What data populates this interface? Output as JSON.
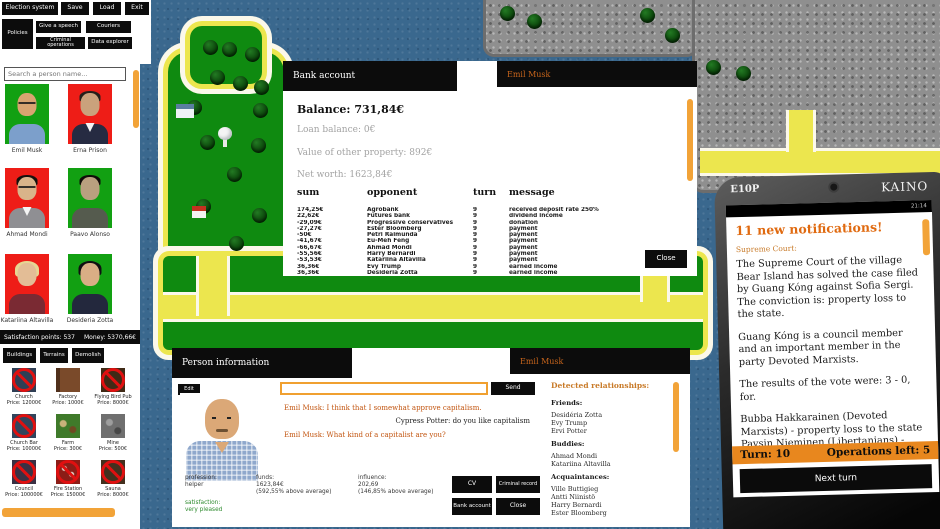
{
  "menu": {
    "items": [
      "Election system",
      "Save",
      "Load",
      "Exit",
      "Policies",
      "Give a speech",
      "Couriers",
      "Criminal operations",
      "Data explorer"
    ]
  },
  "sidebar": {
    "search_placeholder": "Search a person name...",
    "people": [
      "Emil Musk",
      "Erna Prison",
      "Ahmad Mondi",
      "Paavo Alonso",
      "Katariina Altavilla",
      "Desideria Zotta"
    ],
    "status": {
      "satisfaction": "Satisfaction points: 537",
      "money": "Money: 5370,66€"
    },
    "tabs": [
      "Buildings",
      "Terrains",
      "Demolish"
    ],
    "buildings": [
      {
        "name": "Church",
        "price": "Price: 12000€"
      },
      {
        "name": "Factory",
        "price": "Price: 1000€"
      },
      {
        "name": "Flying Bird Pub",
        "price": "Price: 8000€"
      },
      {
        "name": "Church Bar",
        "price": "Price: 10000€"
      },
      {
        "name": "Farm",
        "price": "Price: 300€"
      },
      {
        "name": "Mine",
        "price": "Price: 500€"
      },
      {
        "name": "Council",
        "price": "Price: 100000€"
      },
      {
        "name": "Fire Station",
        "price": "Price: 15000€"
      },
      {
        "name": "Sauna",
        "price": "Price: 8000€"
      }
    ]
  },
  "bank": {
    "title": "Bank account",
    "person_tab": "Emil Musk",
    "balance": "Balance: 731,84€",
    "loan": "Loan balance: 0€",
    "property": "Value of other property: 892€",
    "net_worth": "Net worth: 1623,84€",
    "columns": [
      "sum",
      "opponent",
      "turn",
      "message"
    ],
    "rows": [
      [
        "174,25€",
        "Agrobank",
        "9",
        "received deposit rate 250%"
      ],
      [
        "22,62€",
        "Futures bank",
        "9",
        "dividend income"
      ],
      [
        "-29,09€",
        "Progressive conservatives",
        "9",
        "donation"
      ],
      [
        "-27,27€",
        "Ester Bloomberg",
        "9",
        "payment"
      ],
      [
        "-50€",
        "Petri Raimunda",
        "9",
        "payment"
      ],
      [
        "-41,67€",
        "Eu-Meh Féng",
        "9",
        "payment"
      ],
      [
        "-66,67€",
        "Ahmad Mondi",
        "9",
        "payment"
      ],
      [
        "-55,56€",
        "Harry Bernardi",
        "9",
        "payment"
      ],
      [
        "-53,53€",
        "Katariina Altavilla",
        "9",
        "payment"
      ],
      [
        "36,36€",
        "Evy Trump",
        "9",
        "earned income"
      ],
      [
        "36,36€",
        "Desidéria Zotta",
        "9",
        "earned income"
      ]
    ],
    "close_label": "Close"
  },
  "person": {
    "title": "Person information",
    "person_tab": "Emil Musk",
    "edit_label": "Edit",
    "chat_input_value": "",
    "send_label": "Send",
    "chat": [
      "Emil Musk: I think that I somewhat approve capitalism.",
      "Cypress Potter: do you like capitalism",
      "Emil Musk: What kind of a capitalist are you?"
    ],
    "profession_label": "profession:",
    "profession": "helper",
    "funds_label": "funds:",
    "funds": "1623,84€",
    "funds_note": "(592,55% above average)",
    "influence_label": "influence:",
    "influence": "202,69",
    "influence_note": "(146,85% above average)",
    "satisfaction_label": "satisfaction:",
    "satisfaction": "very pleased",
    "buttons": {
      "cv": "CV",
      "criminal": "Criminal record",
      "bank": "Bank account",
      "close": "Close"
    },
    "relationships": {
      "title": "Detected relationships:",
      "friends_label": "Friends:",
      "friends": [
        "Desidéria Zotta",
        "Evy Trump",
        "Ervi Potter"
      ],
      "buddies_label": "Buddies:",
      "buddies": [
        "Ahmad Mondi",
        "Katariina Altavilla"
      ],
      "acquaintances_label": "Acquaintances:",
      "acquaintances": [
        "Ville Buttigieg",
        "Antti Niinistö",
        "Harry Bernardi",
        "Ester Bloomberg"
      ]
    }
  },
  "phone": {
    "brand_left": "E10P",
    "brand_right": "KAINO",
    "clock": "21:14",
    "notif_title": "11 new notifications!",
    "notif_source": "Supreme Court:",
    "paragraphs": [
      "The Supreme Court of the village Bear Island has solved the case filed by Guang Kóng against Sofia Sergi. The conviction is: property loss to the state.",
      "Guang Kóng is a council member and an important member in the party Devoted Marxists.",
      "The results of the vote were: 3 - 0, for.",
      "Bubba Hakkarainen (Devoted Marxists) - property loss to the state",
      "Paysin Nieminen (Libertanians) - property loss to the state",
      "Paavo Alonso (Libertanians) - property loss to the state"
    ],
    "turn_label": "Turn: 10",
    "ops_label": "Operations left: 5",
    "next_turn_label": "Next turn"
  }
}
